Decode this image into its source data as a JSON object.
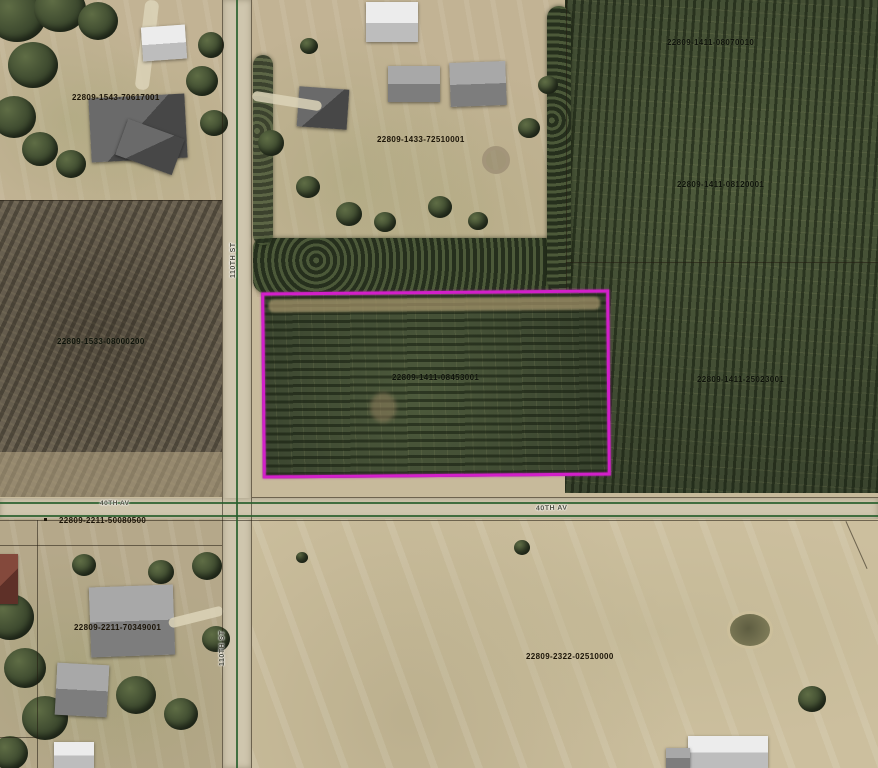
{
  "map": {
    "type": "aerial-parcel-map",
    "highlight_color": "#d21fc9",
    "boundary_line_color": "#285f2d",
    "highlighted_parcel_id": "22809-1411-08453001",
    "parcels": [
      {
        "id": "22809-1543-70617001"
      },
      {
        "id": "22809-1433-72510001"
      },
      {
        "id": "22809-1411-08070010"
      },
      {
        "id": "22809-1411-08120001"
      },
      {
        "id": "22809-1533-08000200"
      },
      {
        "id": "22809-1411-08453001"
      },
      {
        "id": "22809-1411-25023001"
      },
      {
        "id": "22809-2211-50080500"
      },
      {
        "id": "22809-2211-70349001"
      },
      {
        "id": "22809-2322-02510000"
      }
    ],
    "road_labels": [
      {
        "name": "40TH AV"
      },
      {
        "name": "40TH AV"
      },
      {
        "name": "110TH ST"
      },
      {
        "name": "110TH ST"
      }
    ]
  }
}
